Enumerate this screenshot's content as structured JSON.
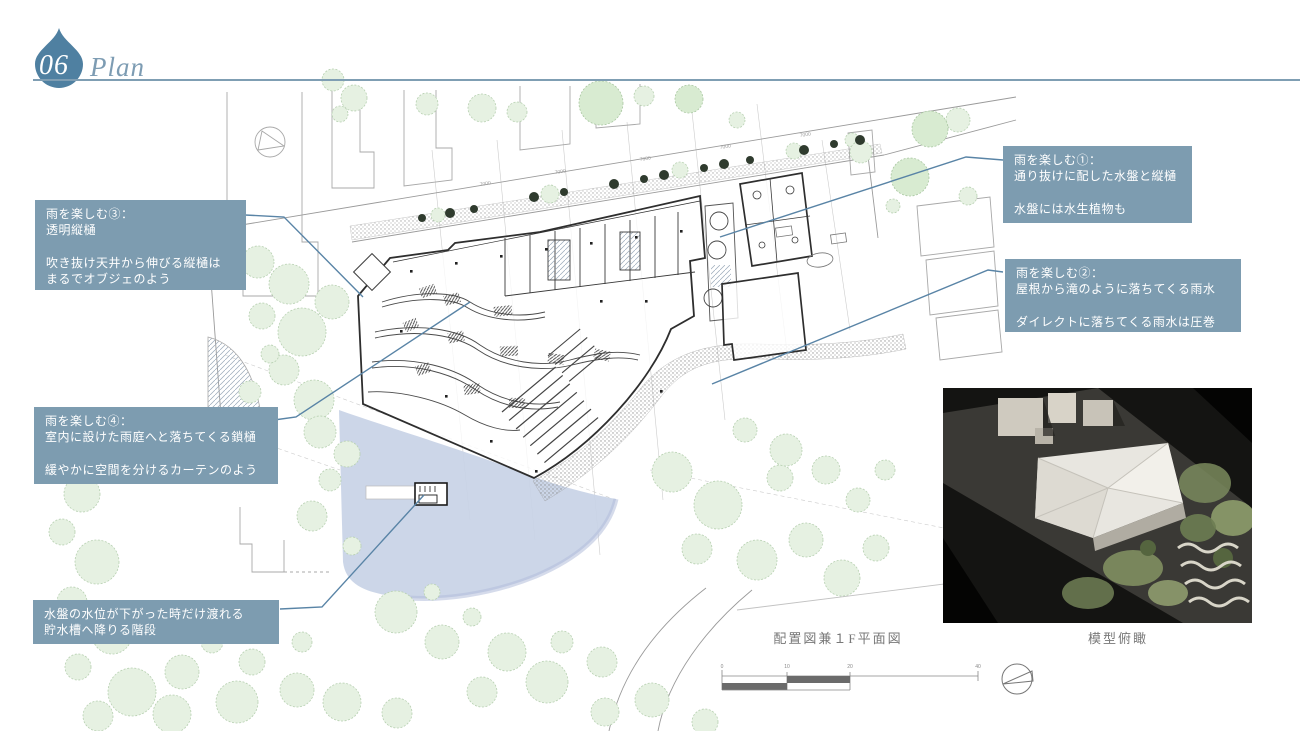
{
  "header": {
    "number": "06",
    "title": "Plan"
  },
  "notes": {
    "note1": {
      "text": "雨を楽しむ①：\n通り抜けに配した水盤と縦樋\n\n水盤には水生植物も"
    },
    "note2": {
      "text": "雨を楽しむ②：\n屋根から滝のように落ちてくる雨水\n\nダイレクトに落ちてくる雨水は圧巻"
    },
    "note3": {
      "text": "雨を楽しむ③：\n透明縦樋\n\n吹き抜け天井から伸びる縦樋は\nまるでオブジェのよう"
    },
    "note4": {
      "text": "雨を楽しむ④：\n室内に設けた雨庭へと落ちてくる鎖樋\n\n緩やかに空間を分けるカーテンのよう"
    },
    "note5": {
      "text": "水盤の水位が下がった時だけ渡れる\n貯水槽へ降りる階段"
    }
  },
  "captions": {
    "site_plan": "配置図兼１F平面図",
    "model": "模型俯瞰"
  },
  "scale_bar": {
    "labels": [
      "0",
      "10",
      "20",
      "40"
    ]
  },
  "plan": {
    "road_dimension": "7000"
  },
  "icons": {
    "header_icon": "water-drop",
    "north_arrow": "compass-north-arrow"
  },
  "colors": {
    "note_bg": "#7d9cb0",
    "leader": "#5984a6",
    "accent": "#4f80a1",
    "pond": "#c8d2e6"
  }
}
